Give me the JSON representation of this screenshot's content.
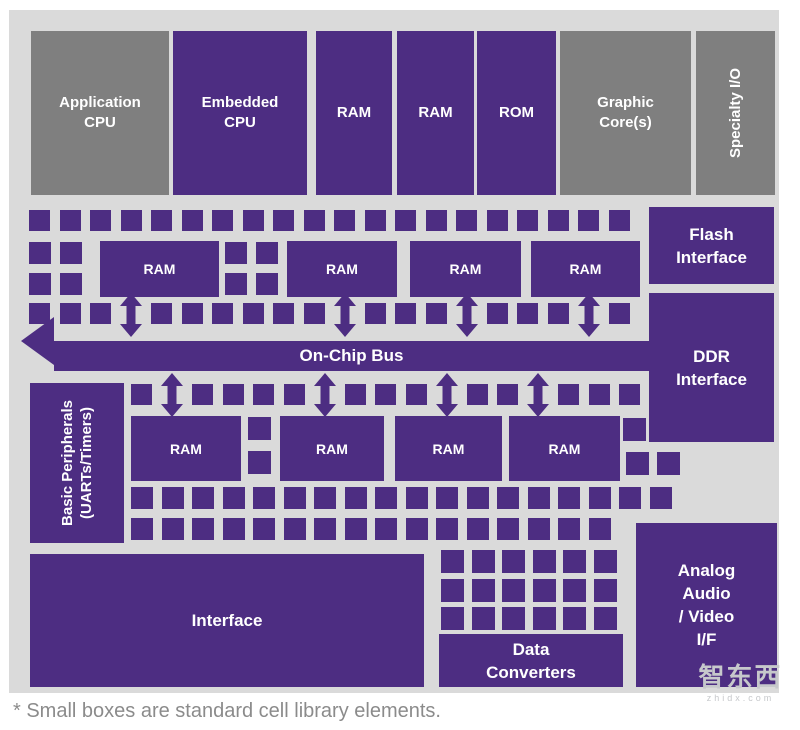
{
  "footnote": "* Small boxes are standard cell library elements.",
  "watermark": {
    "logo_text": "智东西",
    "sub_text": "zhidx.com"
  },
  "colors": {
    "block_purple": "#4D2D82",
    "block_gray": "#7F7F7F",
    "canvas_bg": "#DADADA",
    "label_text": "#FFFFFF",
    "footnote_text": "#8B8B8B",
    "watermark_text": "#C6C8CB"
  },
  "diagram": {
    "bus": {
      "label": "On-Chip Bus"
    },
    "blocks": [
      {
        "id": "application-cpu",
        "lines": [
          "Application",
          "CPU"
        ],
        "kind": "gray",
        "cls": "fs-top",
        "x": 22,
        "y": 21,
        "w": 138,
        "h": 164
      },
      {
        "id": "embedded-cpu",
        "lines": [
          "Embedded",
          "CPU"
        ],
        "kind": "purple",
        "cls": "fs-top",
        "x": 164,
        "y": 21,
        "w": 134,
        "h": 164
      },
      {
        "id": "ram-top-1",
        "lines": [
          "RAM"
        ],
        "kind": "purple",
        "cls": "fs-top",
        "x": 307,
        "y": 21,
        "w": 76,
        "h": 164
      },
      {
        "id": "ram-top-2",
        "lines": [
          "RAM"
        ],
        "kind": "purple",
        "cls": "fs-top",
        "x": 388,
        "y": 21,
        "w": 77,
        "h": 164
      },
      {
        "id": "rom-top",
        "lines": [
          "ROM"
        ],
        "kind": "purple",
        "cls": "fs-top",
        "x": 468,
        "y": 21,
        "w": 79,
        "h": 164
      },
      {
        "id": "graphic-cores",
        "lines": [
          "Graphic",
          "Core(s)"
        ],
        "kind": "gray",
        "cls": "fs-top",
        "x": 551,
        "y": 21,
        "w": 131,
        "h": 164
      },
      {
        "id": "specialty-io",
        "lines": [
          "Specialty I/O"
        ],
        "kind": "gray",
        "cls": "fs-top",
        "x": 687,
        "y": 21,
        "w": 79,
        "h": 164,
        "vertical": true
      },
      {
        "id": "flash-interface",
        "lines": [
          "Flash",
          "Interface"
        ],
        "kind": "purple",
        "cls": "fs-io",
        "x": 640,
        "y": 197,
        "w": 125,
        "h": 77
      },
      {
        "id": "ddr-interface",
        "lines": [
          "DDR",
          "Interface"
        ],
        "kind": "purple",
        "cls": "fs-io",
        "x": 640,
        "y": 283,
        "w": 125,
        "h": 149
      },
      {
        "id": "ram-upper-1",
        "lines": [
          "RAM"
        ],
        "kind": "purple",
        "cls": "fs-ram",
        "x": 91,
        "y": 231,
        "w": 119,
        "h": 56
      },
      {
        "id": "ram-upper-2",
        "lines": [
          "RAM"
        ],
        "kind": "purple",
        "cls": "fs-ram",
        "x": 278,
        "y": 231,
        "w": 110,
        "h": 56
      },
      {
        "id": "ram-upper-3",
        "lines": [
          "RAM"
        ],
        "kind": "purple",
        "cls": "fs-ram",
        "x": 401,
        "y": 231,
        "w": 111,
        "h": 56
      },
      {
        "id": "ram-upper-4",
        "lines": [
          "RAM"
        ],
        "kind": "purple",
        "cls": "fs-ram",
        "x": 522,
        "y": 231,
        "w": 109,
        "h": 56
      },
      {
        "id": "basic-peripherals",
        "lines": [
          "Basic Peripherals",
          "(UARTs/Timers)"
        ],
        "kind": "purple",
        "cls": "fs-side",
        "x": 21,
        "y": 373,
        "w": 94,
        "h": 160,
        "vertical": true
      },
      {
        "id": "ram-lower-1",
        "lines": [
          "RAM"
        ],
        "kind": "purple",
        "cls": "fs-ram",
        "x": 122,
        "y": 406,
        "w": 110,
        "h": 65
      },
      {
        "id": "ram-lower-2",
        "lines": [
          "RAM"
        ],
        "kind": "purple",
        "cls": "fs-ram",
        "x": 271,
        "y": 406,
        "w": 104,
        "h": 65
      },
      {
        "id": "ram-lower-3",
        "lines": [
          "RAM"
        ],
        "kind": "purple",
        "cls": "fs-ram",
        "x": 386,
        "y": 406,
        "w": 107,
        "h": 65
      },
      {
        "id": "ram-lower-4",
        "lines": [
          "RAM"
        ],
        "kind": "purple",
        "cls": "fs-ram",
        "x": 500,
        "y": 406,
        "w": 111,
        "h": 65
      },
      {
        "id": "interface-block",
        "lines": [
          "Interface"
        ],
        "kind": "purple",
        "cls": "fs-io",
        "x": 21,
        "y": 544,
        "w": 394,
        "h": 133
      },
      {
        "id": "data-converters",
        "lines": [
          "Data",
          "Converters"
        ],
        "kind": "purple",
        "cls": "fs-io",
        "x": 430,
        "y": 624,
        "w": 184,
        "h": 53
      },
      {
        "id": "analog-audio-video-if",
        "lines": [
          "Analog",
          "Audio",
          "/ Video",
          "I/F"
        ],
        "kind": "purple",
        "cls": "fs-io",
        "x": 627,
        "y": 513,
        "w": 141,
        "h": 164
      }
    ],
    "bus_geometry": {
      "body_x": 45,
      "body_y": 331,
      "body_w": 595,
      "body_h": 30,
      "head_x": 12,
      "head_y": 307
    },
    "small_square_grids": [
      {
        "name": "cell-row-a",
        "x": 20,
        "y": 200,
        "cols": 20,
        "pitch": 30.5,
        "size": 21
      },
      {
        "name": "cell-cols-upper-left",
        "xs": [
          20,
          51
        ],
        "ys": [
          232,
          263
        ],
        "size": 22
      },
      {
        "name": "cell-cols-upper-mid",
        "xs": [
          216,
          247
        ],
        "ys": [
          232,
          263
        ],
        "size": 22
      },
      {
        "name": "cell-row-d",
        "x": 20,
        "y": 293,
        "cols": 20,
        "pitch": 30.5,
        "size": 21,
        "skip": [
          3,
          10,
          14,
          18
        ]
      },
      {
        "name": "cell-row-e",
        "x": 122,
        "y": 374,
        "cols": 17,
        "pitch": 30.5,
        "size": 21,
        "skip": [
          1,
          6,
          10,
          13
        ]
      },
      {
        "name": "cell-col-lower-mid",
        "xs": [
          239
        ],
        "ys": [
          407,
          441
        ],
        "size": 23
      },
      {
        "name": "cell-right-cluster",
        "cells": [
          [
            614,
            408
          ],
          [
            617,
            442
          ],
          [
            648,
            442
          ]
        ],
        "size": 23
      },
      {
        "name": "cell-row-g",
        "x": 122,
        "y": 477,
        "cols": 18,
        "pitch": 30.5,
        "size": 22
      },
      {
        "name": "cell-row-h",
        "x": 122,
        "y": 508,
        "cols": 16,
        "pitch": 30.5,
        "size": 22
      },
      {
        "name": "cell-grid-bottom",
        "xs": [
          432,
          462.5,
          493,
          523.5,
          554,
          584.5
        ],
        "ys": [
          540,
          568.5,
          597
        ],
        "size": 23
      }
    ],
    "arrows": {
      "upper": {
        "y": 283,
        "centers": [
          122,
          335.5,
          457.5,
          579.5
        ]
      },
      "lower": {
        "y": 363,
        "centers": [
          163,
          315.5,
          437.5,
          529
        ]
      },
      "w": 22,
      "h": 44
    }
  }
}
